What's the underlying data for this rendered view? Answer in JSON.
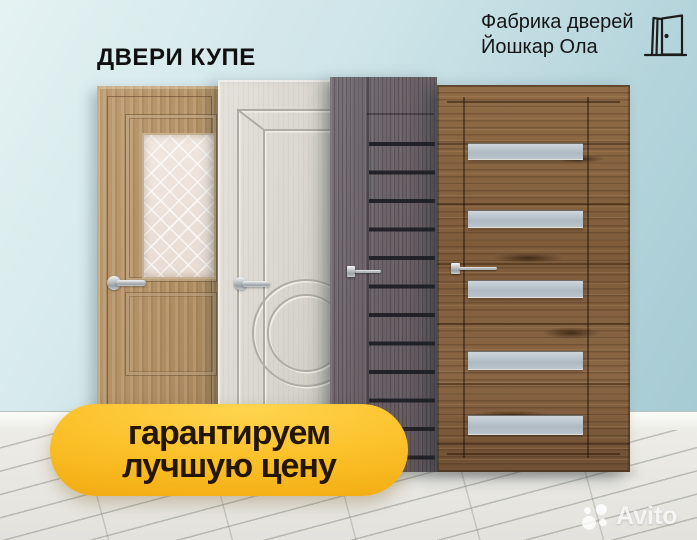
{
  "header": {
    "title": "ДВЕРИ КУПЕ",
    "brand": {
      "line1": "Фабрика дверей",
      "line2": "Йошкар Ола",
      "icon": "open-door-icon"
    }
  },
  "badge": {
    "line1": "гарантируем",
    "line2": "лучшую цену",
    "bg_color": "#f8ba17",
    "text_color": "#231604"
  },
  "watermark": {
    "text": "Avito",
    "icon": "avito-logo-dots-icon",
    "color": "#ffffff"
  },
  "scene": {
    "wall_color_top": "#e4f2f2",
    "wall_color_bottom": "#a3c8d1",
    "baseboard_color": "#f5f5f1",
    "floor_color": "#e9e8e3",
    "doors": [
      {
        "name": "oak-door-with-diamond-glass",
        "finish_color": "#b59067"
      },
      {
        "name": "white-classic-door-circle-molding",
        "finish_color": "#dbd9d1"
      },
      {
        "name": "dark-wenge-door-black-glass-stripes",
        "finish_color": "#6c6267"
      },
      {
        "name": "rustic-oak-door-frosted-glass-stripes",
        "finish_color": "#84613f"
      }
    ]
  }
}
